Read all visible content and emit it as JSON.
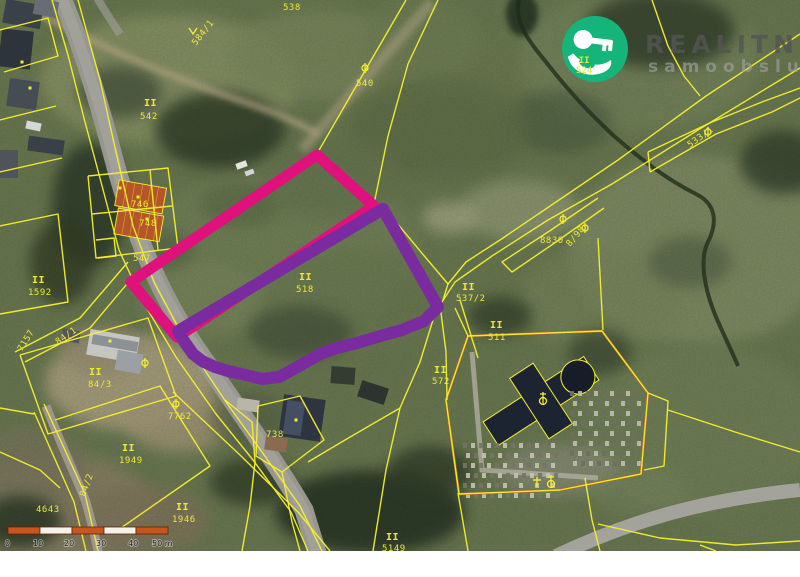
{
  "logo": {
    "line1": "REALITNÍ",
    "line2": "samoobsluha",
    "circle_color": "#14b47a",
    "key_color": "#ffffff",
    "text_color": "rgba(84,84,84,0.82)",
    "subtext_color": "rgba(158,158,158,0.68)",
    "overlay_label_line1": "II",
    "overlay_label_line2": "524"
  },
  "scale_bar": {
    "labels": [
      "0",
      "10",
      "20",
      "30",
      "40",
      "50 m"
    ],
    "segment_color": "#c8551e",
    "alt_color": "#f5f2ea",
    "border_color": "#5c2708",
    "text_color": "#1a1a1a"
  },
  "map": {
    "line_color": "#f5ef2e",
    "label_color": "#efe838",
    "highlight_primary": {
      "name": "pink-parcel-outline",
      "color": "#e0107d",
      "stroke_width": 11,
      "points": [
        [
          317,
          155
        ],
        [
          374,
          206
        ],
        [
          177,
          337
        ],
        [
          131,
          282
        ]
      ]
    },
    "highlight_secondary": {
      "name": "purple-parcel-outline",
      "color": "#7a2ba0",
      "stroke_width": 12,
      "points": [
        [
          383,
          209
        ],
        [
          438,
          307
        ],
        [
          424,
          321
        ],
        [
          402,
          330
        ],
        [
          377,
          337
        ],
        [
          357,
          343
        ],
        [
          337,
          348
        ],
        [
          322,
          353
        ],
        [
          306,
          362
        ],
        [
          292,
          370
        ],
        [
          279,
          377
        ],
        [
          262,
          379
        ],
        [
          246,
          375
        ],
        [
          228,
          371
        ],
        [
          215,
          367
        ],
        [
          202,
          361
        ],
        [
          193,
          354
        ],
        [
          186,
          344
        ],
        [
          180,
          335
        ],
        [
          178,
          331
        ]
      ]
    },
    "parcel_labels": [
      {
        "t": "538",
        "x": 283,
        "y": 10
      },
      {
        "t": "540",
        "x": 356,
        "y": 86
      },
      {
        "t": "II",
        "x": 144,
        "y": 106,
        "b": 1
      },
      {
        "t": "542",
        "x": 140,
        "y": 119
      },
      {
        "t": "584/1",
        "x": 196,
        "y": 46,
        "r": -52
      },
      {
        "t": "746",
        "x": 131,
        "y": 207
      },
      {
        "t": "748",
        "x": 139,
        "y": 226
      },
      {
        "t": "547",
        "x": 133,
        "y": 261
      },
      {
        "t": "II",
        "x": 32,
        "y": 283,
        "b": 1
      },
      {
        "t": "1592",
        "x": 28,
        "y": 295
      },
      {
        "t": "7157",
        "x": 22,
        "y": 352,
        "r": -58
      },
      {
        "t": "84/1",
        "x": 58,
        "y": 345,
        "r": -35
      },
      {
        "t": "II",
        "x": 89,
        "y": 375,
        "b": 1
      },
      {
        "t": "84/3",
        "x": 88,
        "y": 387
      },
      {
        "t": "II",
        "x": 299,
        "y": 280,
        "b": 1
      },
      {
        "t": "518",
        "x": 296,
        "y": 292
      },
      {
        "t": "8830",
        "x": 540,
        "y": 243
      },
      {
        "t": "8/98",
        "x": 570,
        "y": 247,
        "r": -50
      },
      {
        "t": "II",
        "x": 462,
        "y": 290,
        "b": 1
      },
      {
        "t": "537/2",
        "x": 456,
        "y": 301
      },
      {
        "t": "II",
        "x": 490,
        "y": 328,
        "b": 1
      },
      {
        "t": "511",
        "x": 488,
        "y": 340
      },
      {
        "t": "II",
        "x": 434,
        "y": 373,
        "b": 1
      },
      {
        "t": "572",
        "x": 432,
        "y": 384
      },
      {
        "t": "533/1",
        "x": 690,
        "y": 148,
        "r": -36
      },
      {
        "t": "7762",
        "x": 168,
        "y": 419
      },
      {
        "t": "738",
        "x": 266,
        "y": 437
      },
      {
        "t": "II",
        "x": 122,
        "y": 451,
        "b": 1
      },
      {
        "t": "1949",
        "x": 119,
        "y": 463
      },
      {
        "t": "II",
        "x": 176,
        "y": 510,
        "b": 1
      },
      {
        "t": "1946",
        "x": 172,
        "y": 522
      },
      {
        "t": "4643",
        "x": 36,
        "y": 512
      },
      {
        "t": "84/2",
        "x": 85,
        "y": 497,
        "r": -70
      },
      {
        "t": "II",
        "x": 386,
        "y": 540,
        "b": 1
      },
      {
        "t": "5149",
        "x": 382,
        "y": 551
      }
    ],
    "symbols": [
      {
        "x": 563,
        "y": 219,
        "t": "o"
      },
      {
        "x": 585,
        "y": 228,
        "t": "o"
      },
      {
        "x": 708,
        "y": 132,
        "t": "o"
      },
      {
        "x": 176,
        "y": 404,
        "t": "o"
      },
      {
        "x": 365,
        "y": 68,
        "t": "o"
      },
      {
        "x": 145,
        "y": 363,
        "t": "o"
      },
      {
        "x": 543,
        "y": 399,
        "t": "ch"
      },
      {
        "x": 537,
        "y": 482,
        "t": "x"
      },
      {
        "x": 551,
        "y": 482,
        "t": "ch"
      },
      {
        "x": 193,
        "y": 31,
        "t": "v"
      }
    ],
    "dots": [
      [
        138,
        197
      ],
      [
        147,
        219
      ],
      [
        30,
        88
      ],
      [
        296,
        420
      ],
      [
        110,
        341
      ],
      [
        22,
        62
      ],
      [
        120,
        188
      ]
    ],
    "parcel_lines": [
      [
        [
          78,
          0
        ],
        [
          100,
          80
        ],
        [
          116,
          152
        ],
        [
          133,
          226
        ],
        [
          154,
          282
        ],
        [
          186,
          342
        ],
        [
          226,
          402
        ],
        [
          262,
          452
        ],
        [
          300,
          506
        ],
        [
          322,
          551
        ]
      ],
      [
        [
          52,
          0
        ],
        [
          68,
          55
        ],
        [
          85,
          122
        ],
        [
          101,
          182
        ],
        [
          119,
          250
        ],
        [
          143,
          302
        ],
        [
          176,
          357
        ],
        [
          216,
          414
        ],
        [
          253,
          460
        ],
        [
          291,
          512
        ],
        [
          308,
          551
        ]
      ],
      [
        [
          0,
          30
        ],
        [
          48,
          18
        ],
        [
          58,
          56
        ],
        [
          4,
          72
        ]
      ],
      [
        [
          0,
          120
        ],
        [
          56,
          106
        ]
      ],
      [
        [
          0,
          172
        ],
        [
          62,
          158
        ]
      ],
      [
        [
          0,
          226
        ],
        [
          58,
          214
        ],
        [
          68,
          302
        ],
        [
          0,
          314
        ]
      ],
      [
        [
          88,
          176
        ],
        [
          168,
          168
        ],
        [
          178,
          248
        ],
        [
          96,
          258
        ],
        [
          88,
          176
        ]
      ],
      [
        [
          92,
          214
        ],
        [
          172,
          206
        ]
      ],
      [
        [
          150,
          170
        ],
        [
          158,
          250
        ]
      ],
      [
        [
          96,
          240
        ],
        [
          114,
          238
        ],
        [
          116,
          256
        ],
        [
          98,
          258
        ]
      ],
      [
        [
          131,
          282
        ],
        [
          317,
          155
        ],
        [
          374,
          206
        ],
        [
          177,
          337
        ],
        [
          131,
          282
        ]
      ],
      [
        [
          406,
          0
        ],
        [
          318,
          152
        ]
      ],
      [
        [
          438,
          0
        ],
        [
          408,
          64
        ],
        [
          388,
          136
        ],
        [
          374,
          204
        ]
      ],
      [
        [
          383,
          209
        ],
        [
          438,
          307
        ],
        [
          424,
          321
        ],
        [
          402,
          330
        ],
        [
          357,
          343
        ],
        [
          322,
          353
        ],
        [
          292,
          370
        ],
        [
          262,
          379
        ],
        [
          228,
          371
        ],
        [
          202,
          361
        ],
        [
          186,
          344
        ],
        [
          178,
          331
        ],
        [
          383,
          209
        ]
      ],
      [
        [
          800,
          34
        ],
        [
          706,
          96
        ],
        [
          618,
          160
        ],
        [
          556,
          202
        ],
        [
          500,
          240
        ],
        [
          466,
          262
        ],
        [
          448,
          284
        ],
        [
          443,
          300
        ]
      ],
      [
        [
          800,
          68
        ],
        [
          698,
          130
        ],
        [
          612,
          184
        ],
        [
          548,
          220
        ],
        [
          492,
          256
        ],
        [
          455,
          282
        ],
        [
          440,
          305
        ]
      ],
      [
        [
          598,
          198
        ],
        [
          548,
          232
        ],
        [
          502,
          262
        ],
        [
          512,
          272
        ],
        [
          556,
          242
        ],
        [
          604,
          208
        ]
      ],
      [
        [
          652,
          0
        ],
        [
          668,
          46
        ],
        [
          684,
          76
        ],
        [
          700,
          96
        ]
      ],
      [
        [
          648,
          152
        ],
        [
          712,
          122
        ],
        [
          762,
          102
        ],
        [
          800,
          88
        ]
      ],
      [
        [
          650,
          172
        ],
        [
          716,
          134
        ],
        [
          772,
          112
        ],
        [
          800,
          98
        ]
      ],
      [
        [
          648,
          152
        ],
        [
          650,
          172
        ]
      ],
      [
        [
          598,
          238
        ],
        [
          603,
          330
        ]
      ],
      [
        [
          468,
          336
        ],
        [
          602,
          331
        ],
        [
          648,
          393
        ],
        [
          641,
          474
        ],
        [
          560,
          490
        ],
        [
          459,
          494
        ],
        [
          446,
          400
        ],
        [
          468,
          336
        ]
      ],
      [
        [
          455,
          308
        ],
        [
          468,
          336
        ]
      ],
      [
        [
          440,
          305
        ],
        [
          446,
          352
        ],
        [
          447,
          400
        ]
      ],
      [
        [
          458,
          493
        ],
        [
          468,
          551
        ]
      ],
      [
        [
          437,
          307
        ],
        [
          420,
          362
        ],
        [
          400,
          408
        ],
        [
          386,
          470
        ],
        [
          373,
          551
        ]
      ],
      [
        [
          400,
          408
        ],
        [
          345,
          440
        ],
        [
          308,
          462
        ]
      ],
      [
        [
          460,
          300
        ],
        [
          478,
          358
        ]
      ],
      [
        [
          648,
          393
        ],
        [
          668,
          401
        ],
        [
          664,
          466
        ],
        [
          644,
          470
        ]
      ],
      [
        [
          668,
          410
        ],
        [
          735,
          432
        ],
        [
          800,
          452
        ]
      ],
      [
        [
          585,
          478
        ],
        [
          592,
          520
        ],
        [
          600,
          551
        ]
      ],
      [
        [
          598,
          524
        ],
        [
          660,
          538
        ],
        [
          736,
          545
        ],
        [
          800,
          541
        ]
      ],
      [
        [
          700,
          545
        ],
        [
          716,
          551
        ]
      ],
      [
        [
          128,
          262
        ],
        [
          80,
          318
        ],
        [
          15,
          352
        ]
      ],
      [
        [
          137,
          272
        ],
        [
          90,
          328
        ],
        [
          25,
          362
        ]
      ],
      [
        [
          20,
          355
        ],
        [
          148,
          318
        ],
        [
          176,
          396
        ],
        [
          48,
          434
        ],
        [
          20,
          355
        ]
      ],
      [
        [
          44,
          404
        ],
        [
          85,
          494
        ],
        [
          98,
          551
        ]
      ],
      [
        [
          34,
          412
        ],
        [
          74,
          502
        ],
        [
          86,
          551
        ]
      ],
      [
        [
          55,
          420
        ],
        [
          160,
          386
        ],
        [
          210,
          466
        ],
        [
          118,
          530
        ]
      ],
      [
        [
          0,
          408
        ],
        [
          34,
          414
        ]
      ],
      [
        [
          0,
          452
        ],
        [
          40,
          470
        ],
        [
          60,
          488
        ]
      ],
      [
        [
          173,
          392
        ],
        [
          240,
          455
        ],
        [
          298,
          512
        ],
        [
          330,
          551
        ]
      ],
      [
        [
          225,
          400
        ],
        [
          252,
          422
        ],
        [
          255,
          462
        ],
        [
          250,
          506
        ],
        [
          242,
          551
        ]
      ],
      [
        [
          258,
          406
        ],
        [
          300,
          396
        ],
        [
          324,
          440
        ],
        [
          282,
          472
        ],
        [
          256,
          456
        ],
        [
          258,
          406
        ]
      ],
      [
        [
          282,
          472
        ],
        [
          292,
          522
        ],
        [
          300,
          551
        ]
      ],
      [
        [
          386,
          210
        ],
        [
          426,
          258
        ],
        [
          448,
          284
        ]
      ]
    ],
    "cemetery_wall": [
      [
        468,
        336
      ],
      [
        602,
        331
      ],
      [
        648,
        393
      ],
      [
        641,
        474
      ],
      [
        560,
        490
      ],
      [
        459,
        494
      ],
      [
        446,
        400
      ],
      [
        468,
        336
      ]
    ]
  }
}
